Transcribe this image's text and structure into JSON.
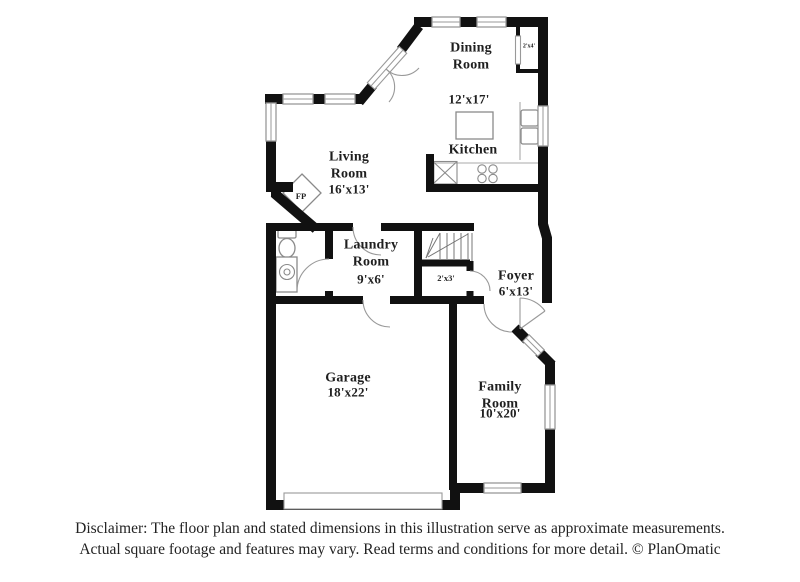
{
  "plan": {
    "rooms": [
      {
        "name": "Dining Room",
        "dims": "12'x17'"
      },
      {
        "name": "Kitchen"
      },
      {
        "name": "Living Room",
        "dims": "16'x13'"
      },
      {
        "name": "Laundry Room",
        "dims": "9'x6'"
      },
      {
        "name": "Foyer",
        "dims": "6'x13'"
      },
      {
        "name": "Garage",
        "dims": "18'x22'"
      },
      {
        "name": "Family Room",
        "dims": "10'x20'"
      }
    ],
    "annotations": {
      "fireplace": "FP",
      "dining_closet": "2'x4'",
      "foyer_closet": "2'x3'"
    }
  },
  "footer": {
    "line1": "Disclaimer: The floor plan and stated dimensions in this illustration serve as approximate measurements.",
    "line2": "Actual square footage and features may vary. Read terms and conditions for more detail. © PlanOmatic"
  },
  "colors": {
    "wall": "#111111",
    "fixture": "#999999",
    "text": "#1f1f1f",
    "background": "#ffffff"
  }
}
